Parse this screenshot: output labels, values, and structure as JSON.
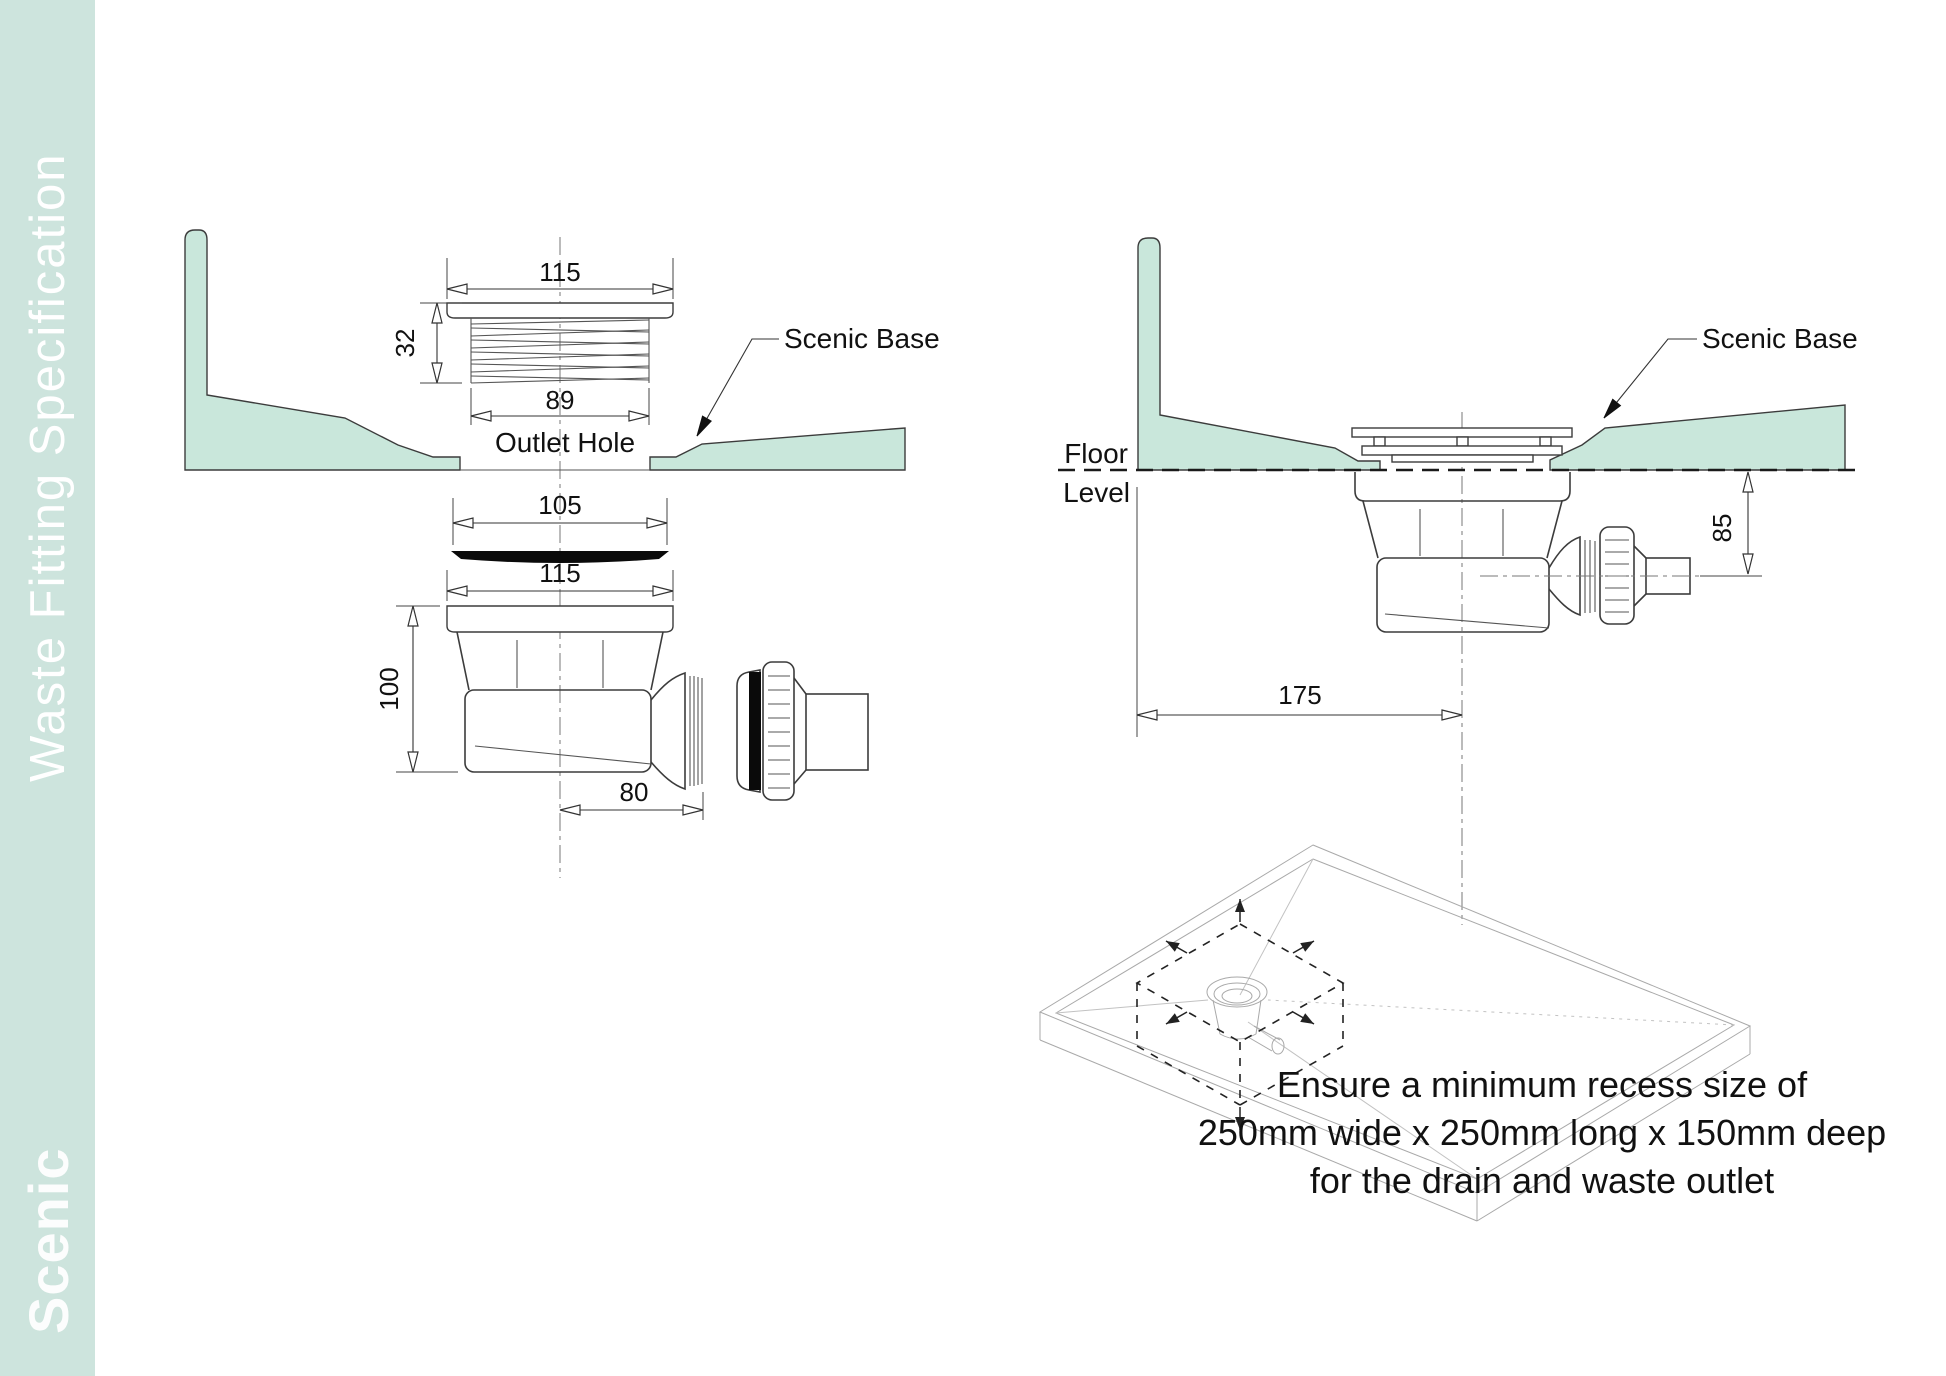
{
  "sidebar": {
    "title": "Waste Fitting Specification",
    "logo": "Scenic",
    "bg_color": "#cde4dd",
    "text_color": "#ffffff"
  },
  "colors": {
    "base_fill": "#c9e7db",
    "line": "#3c3c3c"
  },
  "left_drawing": {
    "dim_flange_width": "115",
    "dim_thread_height": "32",
    "dim_thread_width": "89",
    "outlet_hole_label": "Outlet Hole",
    "base_label": "Scenic Base",
    "dim_cover_width": "105",
    "dim_trap_width": "115",
    "dim_trap_height": "100",
    "dim_outlet_offset": "80"
  },
  "right_drawing": {
    "base_label": "Scenic Base",
    "floor_label_line1": "Floor",
    "floor_label_line2": "Level",
    "dim_outlet_depth": "85",
    "dim_trap_offset": "175"
  },
  "note": {
    "line1": "Ensure a minimum recess size of",
    "line2": "250mm wide x 250mm long x 150mm deep",
    "line3": "for the drain and waste outlet"
  }
}
